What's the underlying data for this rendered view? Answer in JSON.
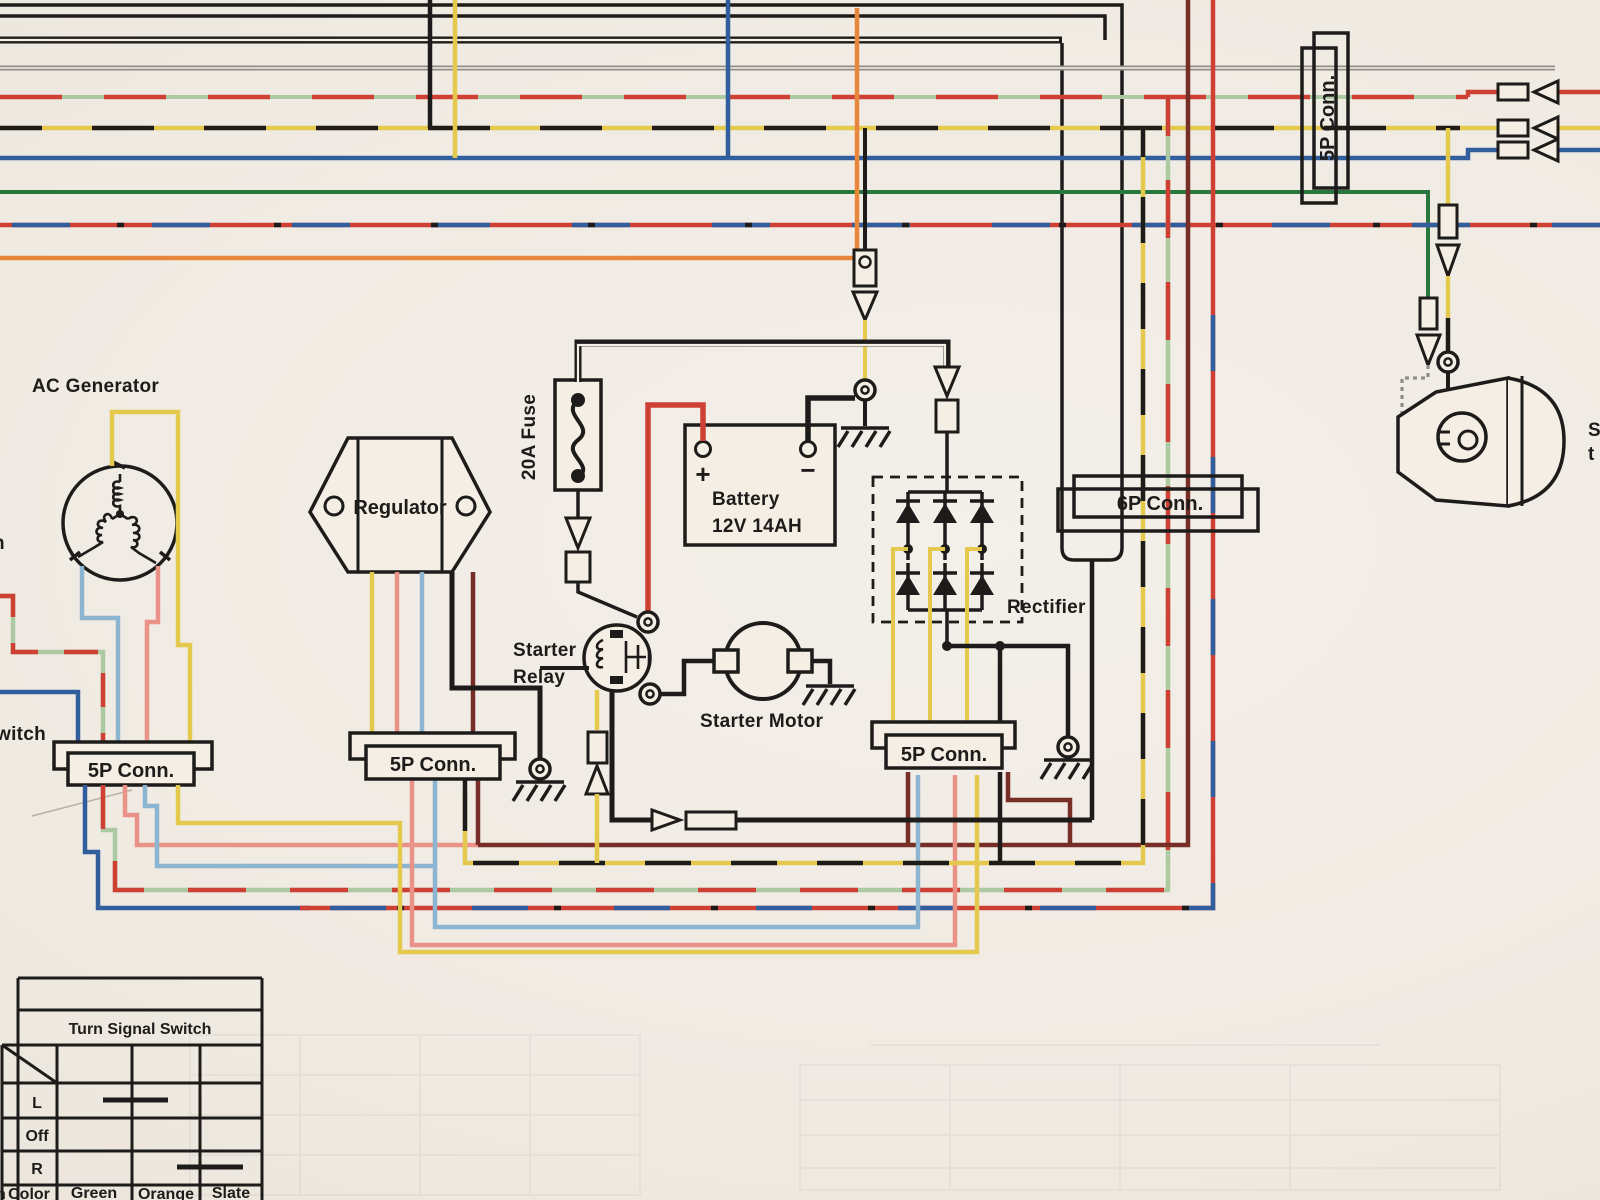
{
  "document": {
    "type": "motorcycle-wiring-diagram-photo",
    "description": "Charging / starting circuit section of a wiring diagram"
  },
  "labels": {
    "ac_generator": "AC Generator",
    "regulator": "Regulator",
    "fuse": "20A Fuse",
    "battery_line1": "Battery",
    "battery_line2": "12V 14AH",
    "battery_plus": "+",
    "battery_minus": "−",
    "starter_relay_line1": "Starter",
    "starter_relay_line2": "Relay",
    "starter_motor": "Starter Motor",
    "rectifier": "Rectifier",
    "conn_5p": "5P Conn.",
    "conn_6p": "6P Conn.",
    "partial_left_top": "h",
    "partial_left_mid": "witch",
    "partial_bottom_left": "n",
    "partial_right_top": "S",
    "partial_right_bottom": "t"
  },
  "turn_signal_switch": {
    "title": "Turn Signal Switch",
    "rows": [
      {
        "label": "L",
        "connected": [
          "Green",
          "Orange"
        ]
      },
      {
        "label": "Off",
        "connected": []
      },
      {
        "label": "R",
        "connected": [
          "Orange",
          "Slate"
        ]
      }
    ],
    "color_row_label": "Color",
    "columns": [
      "Green",
      "Orange",
      "Slate"
    ]
  },
  "colors": {
    "paper": "#f1ece4",
    "ink_black": "#1d1c1a",
    "gray": "#8e8b86",
    "red": "#d93a2f",
    "pink_salmon": "#ef8e85",
    "light_blue": "#85b4d6",
    "blue": "#2a5ea5",
    "green": "#207a3a",
    "pale_green": "#a6c8a0",
    "yellow": "#e6c842",
    "orange": "#ef8432",
    "maroon_dark_red": "#7b2b24"
  },
  "wire_codes_on_page": [
    "black",
    "black/yellow",
    "red",
    "red/green",
    "red/blue",
    "blue",
    "light blue",
    "green",
    "yellow",
    "orange",
    "dark red",
    "gray"
  ]
}
